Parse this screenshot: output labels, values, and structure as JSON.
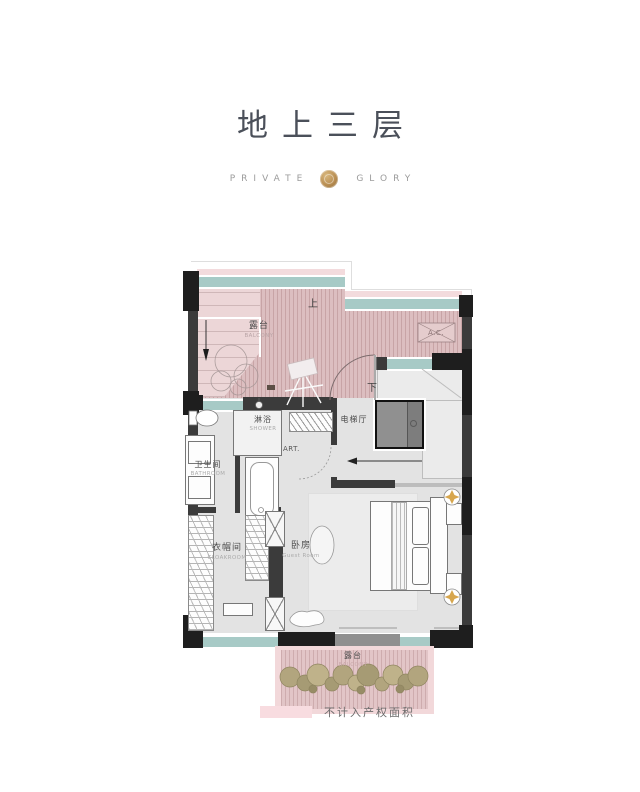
{
  "header": {
    "title": "地上三层",
    "brand": {
      "left": "PRIVATE",
      "right": "GLORY"
    }
  },
  "plan": {
    "up": "上",
    "down": "下",
    "ac": "A.C.",
    "art": "ART.",
    "terrace_top": {
      "zh": "露台",
      "en": "BALCONY"
    },
    "shower": {
      "zh": "淋浴",
      "en": "SHOWER"
    },
    "elevator_hall": {
      "zh": "电梯厅"
    },
    "bathroom": {
      "zh": "卫生间",
      "en": "BATHROOM"
    },
    "cloakroom": {
      "zh": "衣帽间",
      "en": "CLOAKROOM"
    },
    "bedroom": {
      "zh": "卧房",
      "en": "Guest Room"
    },
    "terrace_bottom": {
      "zh": "露台",
      "en": "BALCONY"
    }
  },
  "legend": {
    "label": "不计入产权面积",
    "swatch_color": "#f8dce0"
  },
  "colors": {
    "terrace_pink": "#dcbec0",
    "stair_pink": "#ecd6d7",
    "glass_teal": "#a7cac6",
    "wall_dark": "#3b3b3b",
    "gold": "#d7a64e",
    "title": "#4b505a"
  }
}
